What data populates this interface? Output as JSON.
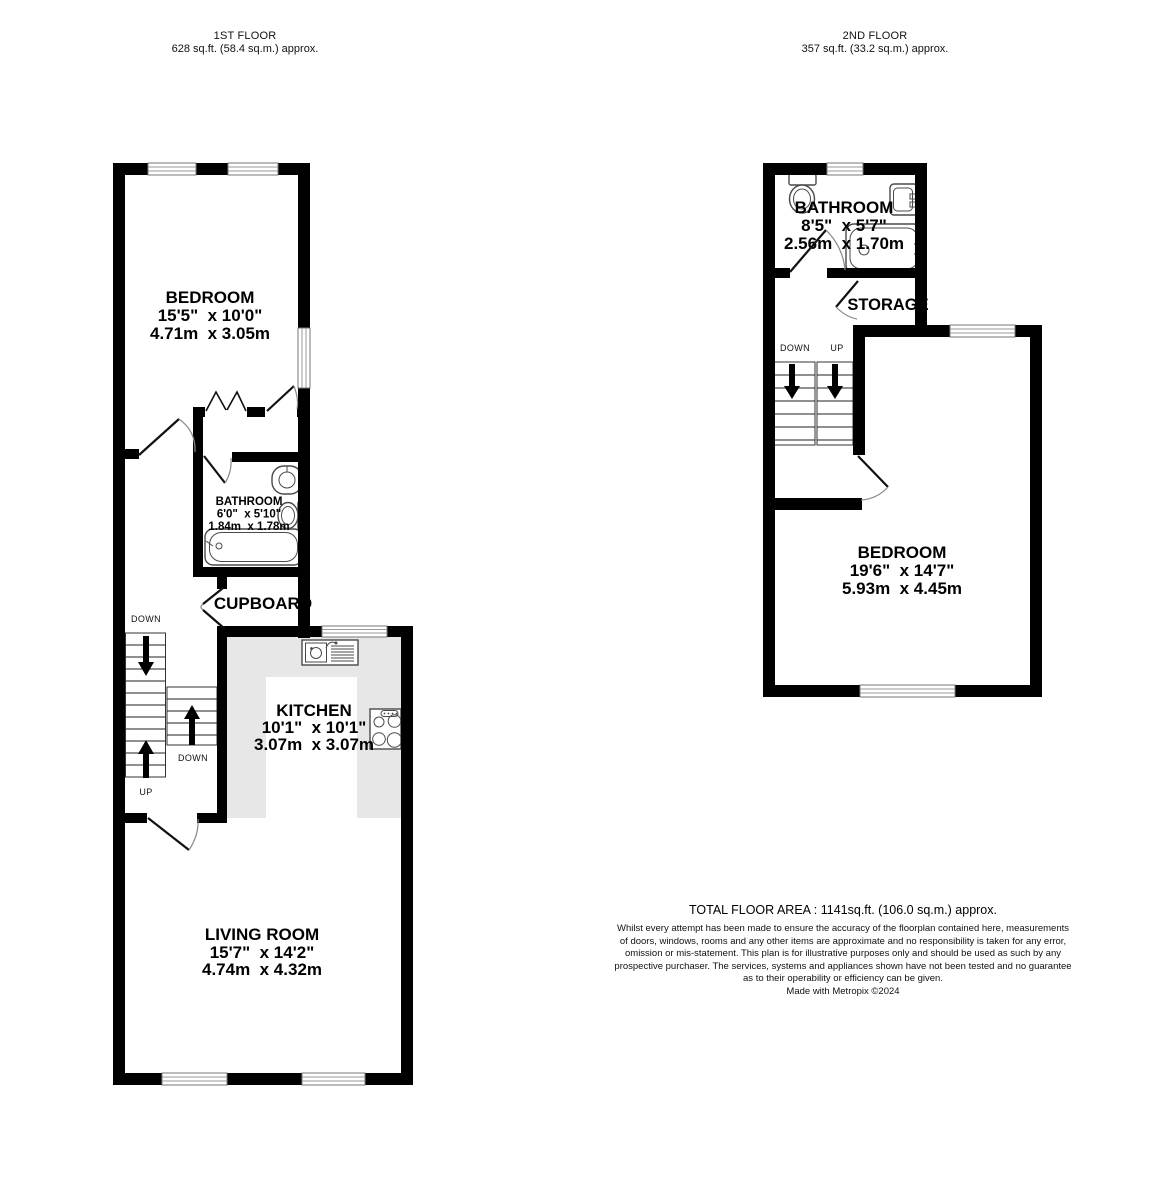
{
  "floors": {
    "first": {
      "title": "1ST FLOOR",
      "area": "628 sq.ft. (58.4 sq.m.) approx.",
      "rooms": {
        "bedroom": {
          "name": "BEDROOM",
          "imperial": "15'5\"  x 10'0\"",
          "metric": "4.71m  x 3.05m"
        },
        "bathroom": {
          "name": "BATHROOM",
          "imperial": "6'0\"  x 5'10\"",
          "metric": "1.84m  x 1.78m"
        },
        "cupboard": {
          "name": "CUPBOARD"
        },
        "kitchen": {
          "name": "KITCHEN",
          "imperial": "10'1\"  x 10'1\"",
          "metric": "3.07m  x 3.07m"
        },
        "living_room": {
          "name": "LIVING ROOM",
          "imperial": "15'7\"  x 14'2\"",
          "metric": "4.74m  x 4.32m"
        }
      },
      "stairs": {
        "top_label": "DOWN",
        "bottom_label": "UP",
        "mid_label": "DOWN"
      }
    },
    "second": {
      "title": "2ND FLOOR",
      "area": "357 sq.ft. (33.2 sq.m.) approx.",
      "rooms": {
        "bathroom": {
          "name": "BATHROOM",
          "imperial": "8'5\"  x 5'7\"",
          "metric": "2.56m  x 1.70m"
        },
        "storage": {
          "name": "STORAGE"
        },
        "bedroom": {
          "name": "BEDROOM",
          "imperial": "19'6\"  x 14'7\"",
          "metric": "5.93m  x 4.45m"
        }
      },
      "stairs": {
        "down_label": "DOWN",
        "up_label": "UP"
      }
    }
  },
  "footer": {
    "total_area": "TOTAL FLOOR AREA : 1141sq.ft. (106.0 sq.m.) approx.",
    "disclaimer_lines": [
      "Whilst every attempt has been made to ensure the accuracy of the floorplan contained here, measurements",
      "of doors, windows, rooms and any other items are approximate and no responsibility is taken for any error,",
      "omission or mis-statement. This plan is for illustrative purposes only and should be used as such by any",
      "prospective purchaser. The services, systems and appliances shown have not been tested and no guarantee",
      "as to their operability or efficiency can be given."
    ],
    "credit": "Made with Metropix ©2024"
  },
  "colors": {
    "wall": "#000000",
    "counter": "#e7e7e7",
    "fixture": "#4a4a4a",
    "window_line": "#999999",
    "door_arc": "#888888"
  }
}
